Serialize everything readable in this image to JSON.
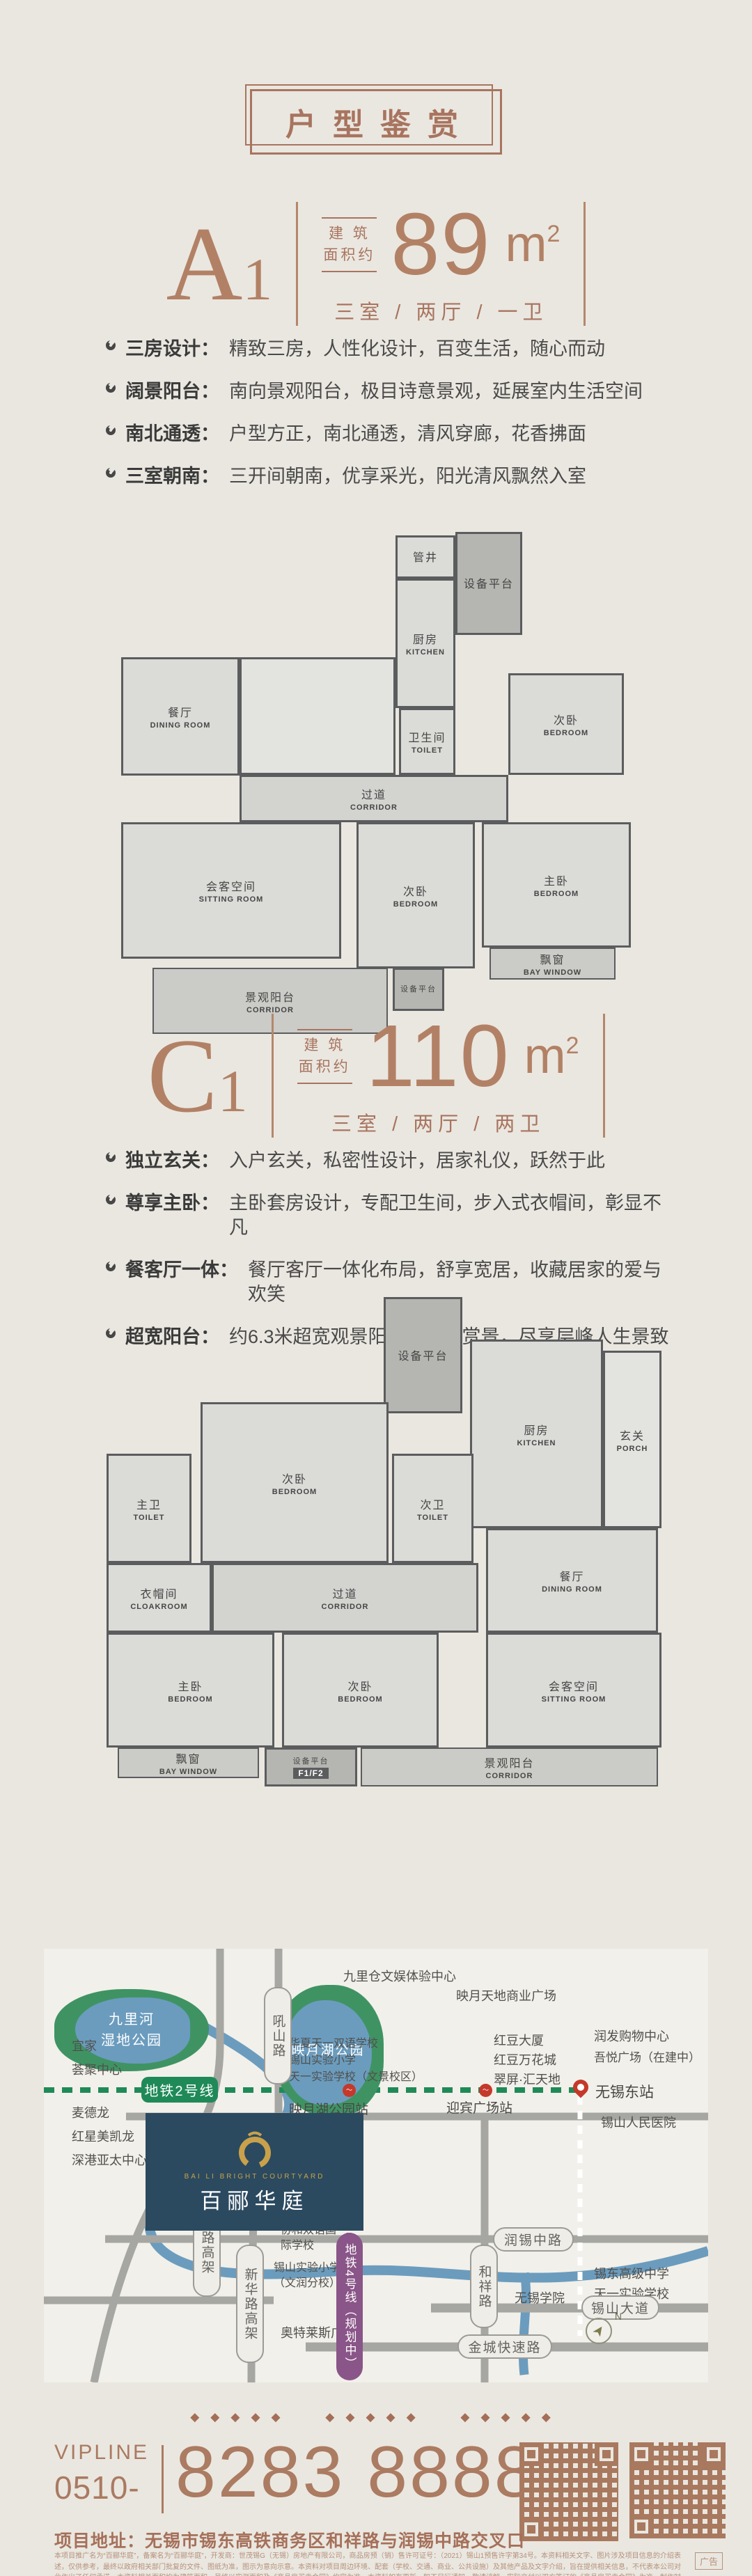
{
  "title": "户型鉴赏",
  "colors": {
    "background": "#eae7e0",
    "accent_brown": "#a8745f",
    "number_brown": "#b28165",
    "text_dark": "#3a3a3a",
    "plan_wall": "#5b5c5e",
    "plan_room": "#dbdbd8",
    "map_background": "#f2f0ea",
    "park_green": "#3f9363",
    "water_blue": "#6b9cbe",
    "road_gray": "#a6a6a2",
    "metro_line2_green": "#1f8a58",
    "metro_line4_purple": "#8a5588",
    "station_red": "#c4392b",
    "project_navy": "#2b4a60",
    "logo_gold": "#c9a14b"
  },
  "units": [
    {
      "code": "A",
      "code_sub": "1",
      "area_label_top": "建 筑",
      "area_label_bottom": "面积约",
      "area_value": "89",
      "area_unit": "m",
      "area_sup": "2",
      "layout": "三室 / 两厅 / 一卫",
      "features": [
        {
          "label": "三房设计：",
          "text": "精致三房，人性化设计，百变生活，随心而动"
        },
        {
          "label": "阔景阳台：",
          "text": "南向景观阳台，极目诗意景观，延展室内生活空间"
        },
        {
          "label": "南北通透：",
          "text": "户型方正，南北通透，清风穿廊，花香拂面"
        },
        {
          "label": "三室朝南：",
          "text": "三开间朝南，优享采光，阳光清风飘然入室"
        }
      ],
      "plan": {
        "rooms": [
          {
            "cn": "管井",
            "en": ""
          },
          {
            "cn": "设备平台",
            "en": ""
          },
          {
            "cn": "厨房",
            "en": "KITCHEN"
          },
          {
            "cn": "餐厅",
            "en": "DINING ROOM"
          },
          {
            "cn": "卫生间",
            "en": "TOILET"
          },
          {
            "cn": "次卧",
            "en": "BEDROOM"
          },
          {
            "cn": "过道",
            "en": "CORRIDOR"
          },
          {
            "cn": "会客空间",
            "en": "SITTING ROOM"
          },
          {
            "cn": "次卧",
            "en": "BEDROOM"
          },
          {
            "cn": "主卧",
            "en": "BEDROOM"
          },
          {
            "cn": "飘窗",
            "en": "BAY WINDOW"
          },
          {
            "cn": "景观阳台",
            "en": "CORRIDOR"
          },
          {
            "cn": "设备平台",
            "en": ""
          }
        ]
      }
    },
    {
      "code": "C",
      "code_sub": "1",
      "area_label_top": "建 筑",
      "area_label_bottom": "面积约",
      "area_value": "110",
      "area_unit": "m",
      "area_sup": "2",
      "layout": "三室 / 两厅 / 两卫",
      "features": [
        {
          "label": "独立玄关：",
          "text": "入户玄关，私密性设计，居家礼仪，跃然于此"
        },
        {
          "label": "尊享主卧：",
          "text": "主卧套房设计，专配卫生间，步入式衣帽间，彰显不凡"
        },
        {
          "label": "餐客厅一体：",
          "text": "餐厅客厅一体化布局，舒享宽居，收藏居家的爱与欢笑"
        },
        {
          "label": "超宽阳台：",
          "text": "约6.3米超宽观景阳台，品茗赏景，尽享层峰人生景致"
        }
      ],
      "plan": {
        "rooms": [
          {
            "cn": "设备平台",
            "en": ""
          },
          {
            "cn": "厨房",
            "en": "KITCHEN"
          },
          {
            "cn": "玄关",
            "en": "PORCH"
          },
          {
            "cn": "主卫",
            "en": "TOILET"
          },
          {
            "cn": "次卧",
            "en": "BEDROOM"
          },
          {
            "cn": "次卫",
            "en": "TOILET"
          },
          {
            "cn": "餐厅",
            "en": "DINING ROOM"
          },
          {
            "cn": "衣帽间",
            "en": "CLOAKROOM"
          },
          {
            "cn": "过道",
            "en": "CORRIDOR"
          },
          {
            "cn": "会客空间",
            "en": "SITTING ROOM"
          },
          {
            "cn": "主卧",
            "en": "BEDROOM"
          },
          {
            "cn": "次卧",
            "en": "BEDROOM"
          },
          {
            "cn": "飘窗",
            "en": "BAY WINDOW"
          },
          {
            "cn": "设备平台",
            "en": "F1/F2"
          },
          {
            "cn": "景观阳台",
            "en": "CORRIDOR"
          }
        ]
      }
    }
  ],
  "map": {
    "parks": [
      {
        "line1": "九里河",
        "line2": "湿地公园"
      },
      {
        "line1": "映月湖公园",
        "line2": ""
      }
    ],
    "roads": [
      "吼山路",
      "高浪路高架",
      "新华路高架",
      "和祥路",
      "润锡中路",
      "锡山大道",
      "金城快速路"
    ],
    "metro2": "地铁2号线",
    "metro4": "地铁4号线（规划中）",
    "stations": [
      "映月湖公园站",
      "迎宾广场站",
      "无锡东站"
    ],
    "labels": [
      "九里仓文娱体验中心",
      "映月天地商业广场",
      "宜家",
      "荟聚中心",
      "华夏天一双语学校",
      "锡山实验小学",
      "天一实验学校（文景校区）",
      "润发购物中心",
      "吾悦广场（在建中）",
      "红豆大厦",
      "红豆万花城",
      "翠屏·汇天地",
      "麦德龙",
      "红星美凯龙",
      "深港亚太中心",
      "锡山人民医院",
      "协和双语国际学校",
      "锡山实验小学（文润分校）",
      "锡东高级中学",
      "天一实验学校",
      "无锡学院",
      "奥特莱斯广场"
    ],
    "project": {
      "en": "BAI LI BRIGHT COURTYARD",
      "cn": "百郦华庭"
    },
    "compass": "N"
  },
  "footer": {
    "ornament": "◆◆◆◆◆ ◆◆◆◆◆ ◆◆◆◆◆",
    "vipline": "VIPLINE",
    "tel_prefix": "0510-",
    "tel": "8283 8888",
    "address_label": "项目地址：",
    "address": "无锡市锡东高铁商务区和祥路与润锡中路交叉口",
    "ad_badge": "广告",
    "disclaimer": "本项目推广名为“百郦华庭”，备案名为“百郦华庭”，开发商：世茂锡G（无锡）房地产有限公司，商品房预（销）售许可证号：（2021）锡山1预售许字第34号。本资料相关文字、图片涉及项目信息的介绍表述，仅供参考，最终以政府相关部门批复的文件、图纸为准，图示为意向示意。本资料对项目周边环境、配套（学校、交通、商业、公共设施）及其他产品及文字介绍，旨在提供相关信息，不代表本公司对此作出了任何承诺。本资料相关面积均为建筑面积，最终以实测面积及《商品房买卖合同》约定为准。本资料如有更新，恕不另行通知，敬请谅解。实际交付以双方签订的《商品房买卖合同》为准。制作时间：2021年10月。"
  }
}
